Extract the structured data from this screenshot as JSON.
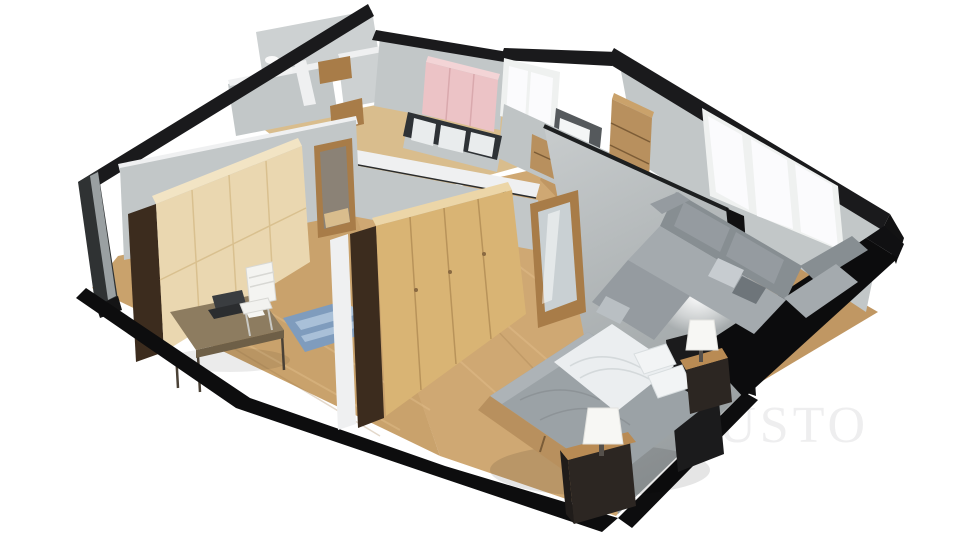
{
  "watermark": {
    "text": "JUSTO"
  },
  "scene": {
    "type": "3d-floorplan-dollhouse-render",
    "view": "aerial cutaway perspective",
    "background": "#ffffff"
  },
  "rooms": [
    {
      "id": "bathroom",
      "location": "back-left",
      "furniture": [
        "washbasin"
      ]
    },
    {
      "id": "wc-hall",
      "location": "back-left",
      "furniture": [
        "oak-door-openings"
      ]
    },
    {
      "id": "kids-room",
      "location": "back-center",
      "furniture": [
        "pink-wardrobe",
        "white-window"
      ]
    },
    {
      "id": "entry",
      "location": "back-center",
      "furniture": [
        "glazed-white-door"
      ]
    },
    {
      "id": "hallway",
      "location": "center",
      "furniture": [
        "dark-glazed-partition",
        "oak-interior-doors"
      ]
    },
    {
      "id": "office",
      "location": "front-left",
      "furniture": [
        "beige-wardrobe",
        "desk",
        "laptop",
        "white-chair",
        "blue-rug"
      ]
    },
    {
      "id": "bedroom",
      "location": "front-center",
      "furniture": [
        "oak-wardrobe",
        "mirror-door",
        "double-bed",
        "white-blanket",
        "pillows",
        "black-headboard",
        "nightstand-front",
        "nightstand-back",
        "table-lamp-front",
        "table-lamp-back"
      ]
    },
    {
      "id": "living-room",
      "location": "right",
      "furniture": [
        "corner-sofa",
        "throw-pillows",
        "triple-pane-window",
        "tv",
        "tv-cabinet",
        "bookcase",
        "plant",
        "oak-door"
      ]
    }
  ],
  "colors": {
    "background": "#ffffff",
    "wall_light": "#cdd1d2",
    "wall_mid": "#c2c7c8",
    "wall_dark": "#9aa0a2",
    "wall_top_dark": "#1a1a1c",
    "wall_cut_white": "#eff0f1",
    "exterior_black": "#0d0d0e",
    "floor_wood": "#c9a26c",
    "floor_wood_light": "#d9bd8d",
    "floor_wood_bedroom": "#cfa873",
    "floor_wood_living": "#c09763",
    "wardrobe_beige": "#ead7b0",
    "wardrobe_oak": "#d9b474",
    "wardrobe_top": "#ecd6a8",
    "wood_dark_side": "#3c2c1e",
    "oak_furniture": "#b8905e",
    "oak_top": "#caa26b",
    "door_oak": "#a87c48",
    "pink_wardrobe": "#ecc3c6",
    "pink_top": "#f3d4d6",
    "window_white": "#fbfbfd",
    "frame_white": "#eff1f0",
    "glass_pale": "#e9eced",
    "partition_dark": "#2e3236",
    "sofa_gray": "#959ba0",
    "sofa_dark": "#878e92",
    "sofa_light": "#a4aaae",
    "rug_blue": "#7f9cbd",
    "rug_blue_light": "#a9c0d8",
    "bed_duvet": "#9ba2a6",
    "blanket_white": "#ebeef0",
    "headboard_black": "#1b1b1c",
    "nightstand_dark": "#2c2622",
    "nightstand_top": "#b98b54",
    "lamp_white": "#f7f7f4",
    "tv_black": "#16181b",
    "plant_green": "#7a8c68",
    "desk_top": "#8d7c60",
    "desk_edge": "#6e5f47",
    "chair_white": "#f2f2ef",
    "mirror_glass": "#c9d0d3",
    "door_opening": "#8b8276",
    "entry_dark": "#55595c",
    "watermark_gray": "#eeeeef"
  }
}
